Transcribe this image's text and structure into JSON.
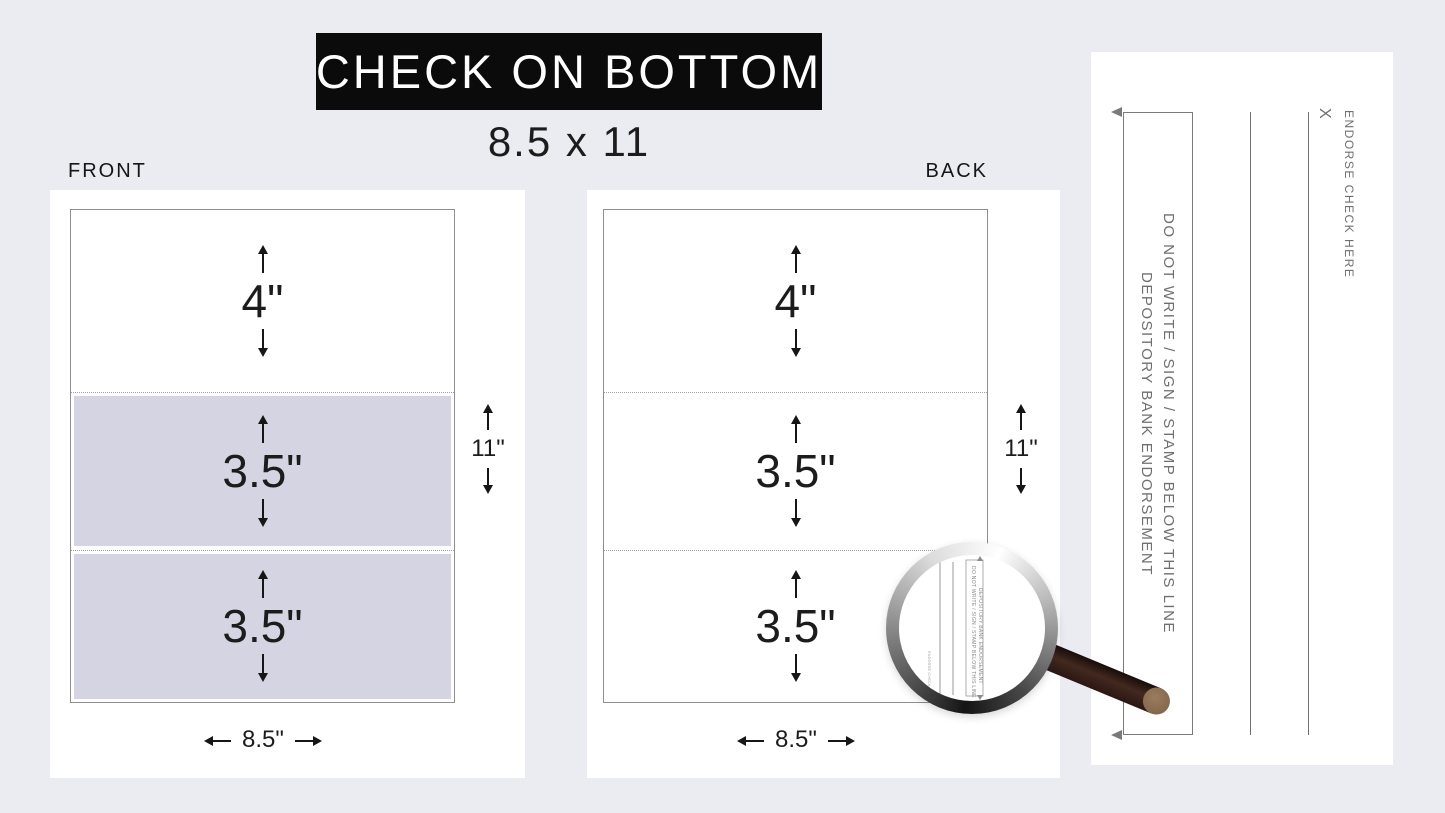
{
  "title": {
    "bar_label": "CHECK ON BOTTOM",
    "size_label": "8.5 x 11"
  },
  "front": {
    "label": "FRONT",
    "section_heights": [
      "4\"",
      "3.5\"",
      "3.5\""
    ],
    "page_width": "8.5\"",
    "page_height": "11\""
  },
  "back": {
    "label": "BACK",
    "section_heights": [
      "4\"",
      "3.5\"",
      "3.5\""
    ],
    "page_width": "8.5\"",
    "page_height": "11\""
  },
  "endorsement_detail": {
    "warning_line": "DO NOT WRITE / SIGN / STAMP BELOW THIS LINE",
    "bank_line": "DEPOSITORY BANK ENDORSEMENT",
    "sign_x": "X",
    "endorse_here": "ENDORSE CHECK HERE"
  },
  "magnifier": {
    "warning_line": "DO NOT WRITE / SIGN / STAMP BELOW THIS LINE",
    "bank_line": "DEPOSITORY BANK ENDORSEMENT",
    "side_label": "ENDORSE CHECK HERE"
  },
  "colors": {
    "background": "#ebebf2",
    "panel": "#ffffff",
    "section_fill": "#d5d4e2",
    "title_bar": "#0b0b0b",
    "title_text": "#ffffff",
    "ink": "#1c1c1c",
    "muted_gray": "#6f6f6f",
    "handle_dark": "#3a241c",
    "handle_cap": "#8f7355"
  }
}
